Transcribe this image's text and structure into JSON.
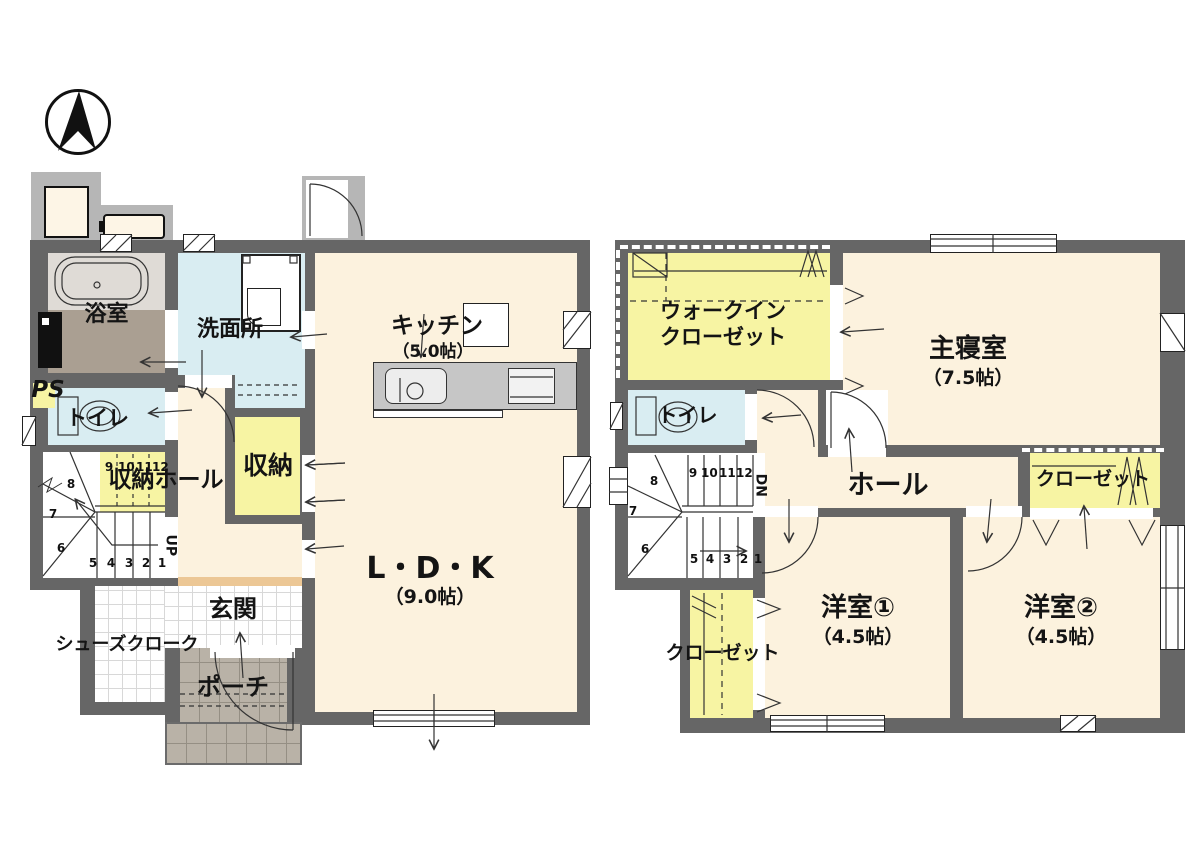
{
  "palette": {
    "wall": "#666666",
    "floor_wood": "#fcf2de",
    "closet_yellow": "#f7f4a3",
    "wet_area_blue": "#d9edf2",
    "bath_floor": "#aa9f92",
    "porch_gray": "#b9b2a7",
    "step_orange": "#ecc795"
  },
  "compass": {
    "icon": "north-arrow"
  },
  "floor1": {
    "rooms": {
      "bath": "浴室",
      "washroom": "洗面所",
      "toilet": "トイレ",
      "ps": "PS",
      "kitchen": "キッチン",
      "kitchen_size": "（5.0帖）",
      "ldk": "L・D・K",
      "ldk_size": "（9.0帖）",
      "storage_hall": "収納ホール",
      "storage": "収納",
      "entrance": "玄関",
      "shoe_cloak": "シューズクローク",
      "porch": "ポーチ"
    },
    "stairs": {
      "direction": "UP",
      "bottom_numbers": [
        "5",
        "4",
        "3",
        "2",
        "1"
      ],
      "winder_numbers": [
        "8",
        "7",
        "6"
      ],
      "upper_numbers": [
        "9",
        "10",
        "11",
        "12"
      ]
    }
  },
  "floor2": {
    "rooms": {
      "wic_line1": "ウォークイン",
      "wic_line2": "クローゼット",
      "master_bedroom": "主寝室",
      "master_size": "（7.5帖）",
      "toilet": "トイレ",
      "hall": "ホール",
      "closet_a": "クローゼット",
      "closet_b": "クローゼット",
      "room1": "洋室①",
      "room1_size": "（4.5帖）",
      "room2": "洋室②",
      "room2_size": "（4.5帖）"
    },
    "stairs": {
      "direction": "DN",
      "bottom_numbers": [
        "5",
        "4",
        "3",
        "2",
        "1"
      ],
      "winder_numbers": [
        "8",
        "7",
        "6"
      ],
      "upper_numbers": [
        "9",
        "10",
        "11",
        "12"
      ]
    }
  }
}
